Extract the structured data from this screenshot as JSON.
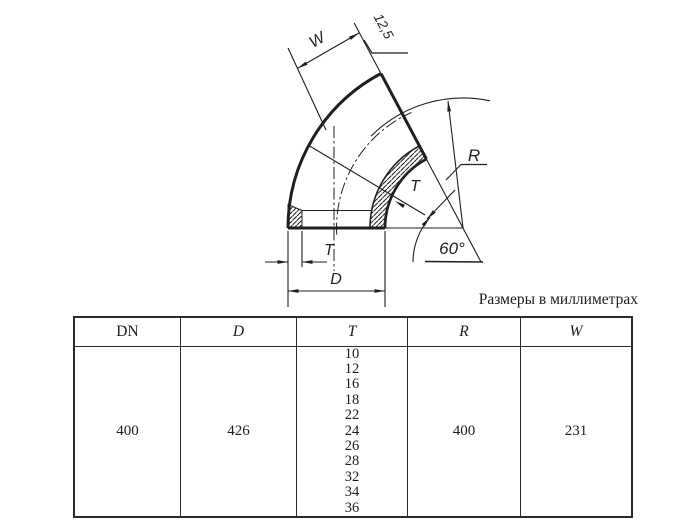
{
  "caption": "Размеры в миллиметрах",
  "drawing": {
    "labels": {
      "width": "W",
      "roughness": "12,5",
      "radius": "R",
      "wall_upper": "T",
      "angle": "60°",
      "wall_lower": "T",
      "diameter": "D"
    }
  },
  "table": {
    "headers": [
      "DN",
      "D",
      "T",
      "R",
      "W"
    ],
    "row": {
      "dn": "400",
      "d": "426",
      "t": [
        "10",
        "12",
        "16",
        "18",
        "22",
        "24",
        "26",
        "28",
        "32",
        "34",
        "36"
      ],
      "r": "400",
      "w": "231"
    }
  },
  "colors": {
    "line": "#1f1f1f",
    "background": "#ffffff"
  }
}
